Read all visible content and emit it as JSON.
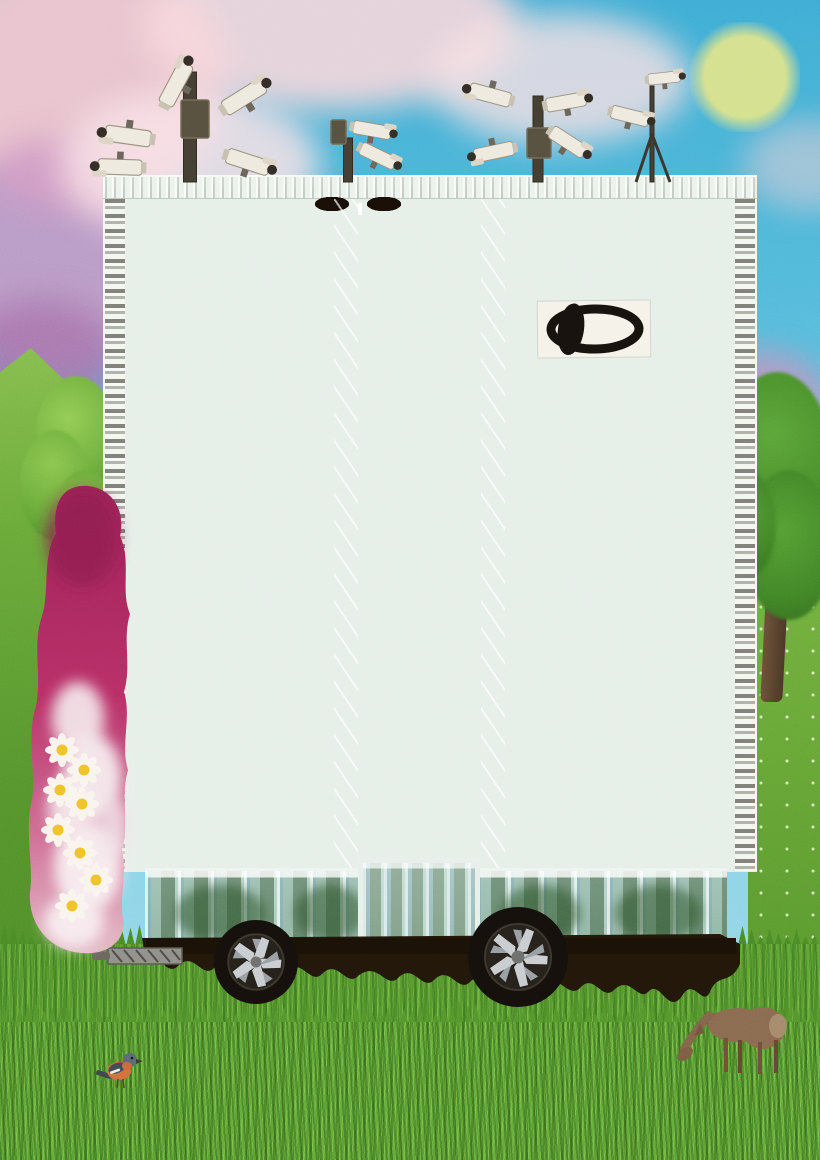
{
  "artwork": {
    "title": "Surveillance tower-block collage",
    "description": "Surreal collage poster: a pale modernist apartment tower mounted on black car wheels parked in a green meadow. Clusters of white CCTV cameras sprout from the roof against a blue sky with pink clouds and a pale green full moon. A black eye logo is fixed to the upper facade, a magenta smoke-and-daisy column climbs the left side, a roe deer grazes and a small orange-breasted bird perches in the grass.",
    "palette": {
      "sky_blue": "#4fb6da",
      "cloud_pink": "#f2c4ca",
      "cloud_purple": "#c08fbe",
      "moon_green": "#d5e18e",
      "facade_pale": "#e7efe9",
      "window_dark": "#2f2721",
      "glass_green": "#b7d2c6",
      "smoke_magenta": "#b52e63",
      "grass_green": "#57992e",
      "chassis_black": "#221709",
      "rim_silver": "#c9cdd0",
      "deer_brown": "#8a6a50",
      "daisy_yellow": "#f0c22a",
      "logo_ink": "#17120e"
    }
  },
  "sky": {
    "moon": {
      "x": 745,
      "y": 77,
      "r": 42,
      "color": "#d5e18e"
    }
  },
  "building": {
    "floor_count": 12,
    "window_cells": [
      {
        "type": "dark",
        "w": 2.2
      },
      {
        "type": "glass",
        "w": 1.4
      },
      {
        "type": "white",
        "w": 0.8
      },
      {
        "type": "dark",
        "w": 1.6
      },
      {
        "type": "glass",
        "w": 2.4
      },
      {
        "type": "dark",
        "w": 1.0
      },
      {
        "type": "white",
        "w": 0.7
      },
      {
        "type": "glass",
        "w": 1.8
      },
      {
        "type": "dark",
        "w": 2.0
      },
      {
        "type": "glass",
        "w": 1.2
      },
      {
        "type": "dark",
        "w": 1.5
      },
      {
        "type": "white",
        "w": 0.9
      },
      {
        "type": "glass",
        "w": 2.2
      },
      {
        "type": "dark",
        "w": 1.3
      }
    ]
  },
  "cameras": {
    "clusters": [
      {
        "name": "cluster-left",
        "pole": {
          "x": 190,
          "y1": 72,
          "y2": 182,
          "w": 13
        },
        "boxes": [
          {
            "x": 181,
            "y": 100,
            "w": 28,
            "h": 38
          }
        ],
        "legs": [],
        "cams": [
          {
            "x": 176,
            "y": 84,
            "rot": -62,
            "s": 1.15
          },
          {
            "x": 128,
            "y": 136,
            "rot": 188,
            "s": 1.15
          },
          {
            "x": 120,
            "y": 167,
            "rot": 182,
            "s": 1.1
          },
          {
            "x": 244,
            "y": 97,
            "rot": -32,
            "s": 1.15
          },
          {
            "x": 248,
            "y": 162,
            "rot": 18,
            "s": 1.1
          }
        ]
      },
      {
        "name": "cluster-mid",
        "pole": {
          "x": 348,
          "y1": 138,
          "y2": 182,
          "w": 9
        },
        "boxes": [
          {
            "x": 331,
            "y": 120,
            "w": 15,
            "h": 24
          }
        ],
        "legs": [],
        "cams": [
          {
            "x": 372,
            "y": 130,
            "rot": 10,
            "s": 0.95
          },
          {
            "x": 378,
            "y": 156,
            "rot": 26,
            "s": 0.95
          }
        ]
      },
      {
        "name": "cluster-right",
        "pole": {
          "x": 538,
          "y1": 96,
          "y2": 182,
          "w": 10
        },
        "boxes": [
          {
            "x": 527,
            "y": 128,
            "w": 24,
            "h": 30
          }
        ],
        "legs": [],
        "cams": [
          {
            "x": 490,
            "y": 95,
            "rot": 195,
            "s": 1.05
          },
          {
            "x": 566,
            "y": 102,
            "rot": -10,
            "s": 1.0
          },
          {
            "x": 494,
            "y": 152,
            "rot": 168,
            "s": 1.0
          },
          {
            "x": 568,
            "y": 142,
            "rot": 33,
            "s": 1.0
          }
        ]
      },
      {
        "name": "cluster-tripod",
        "pole": {
          "x": 652,
          "y1": 86,
          "y2": 182,
          "w": 4
        },
        "boxes": [],
        "legs": [
          {
            "x2": 636,
            "y2": 182
          },
          {
            "x2": 670,
            "y2": 182
          }
        ],
        "cams": [
          {
            "x": 664,
            "y": 78,
            "rot": -6,
            "s": 0.8
          },
          {
            "x": 630,
            "y": 116,
            "rot": 14,
            "s": 0.95
          }
        ]
      }
    ]
  },
  "flower_column": {
    "daisies": [
      {
        "x": 40,
        "y": 272
      },
      {
        "x": 62,
        "y": 292
      },
      {
        "x": 38,
        "y": 312
      },
      {
        "x": 60,
        "y": 326
      },
      {
        "x": 36,
        "y": 352
      },
      {
        "x": 58,
        "y": 375
      },
      {
        "x": 74,
        "y": 402
      },
      {
        "x": 50,
        "y": 428
      }
    ]
  },
  "vehicle": {
    "wheels": [
      {
        "cx": 256,
        "cy": 62,
        "r": 42
      },
      {
        "cx": 518,
        "cy": 57,
        "r": 50
      }
    ]
  },
  "wildlife": {
    "deer": {
      "x": 658,
      "y": 980
    },
    "bird": {
      "x": 94,
      "y": 1046
    }
  }
}
